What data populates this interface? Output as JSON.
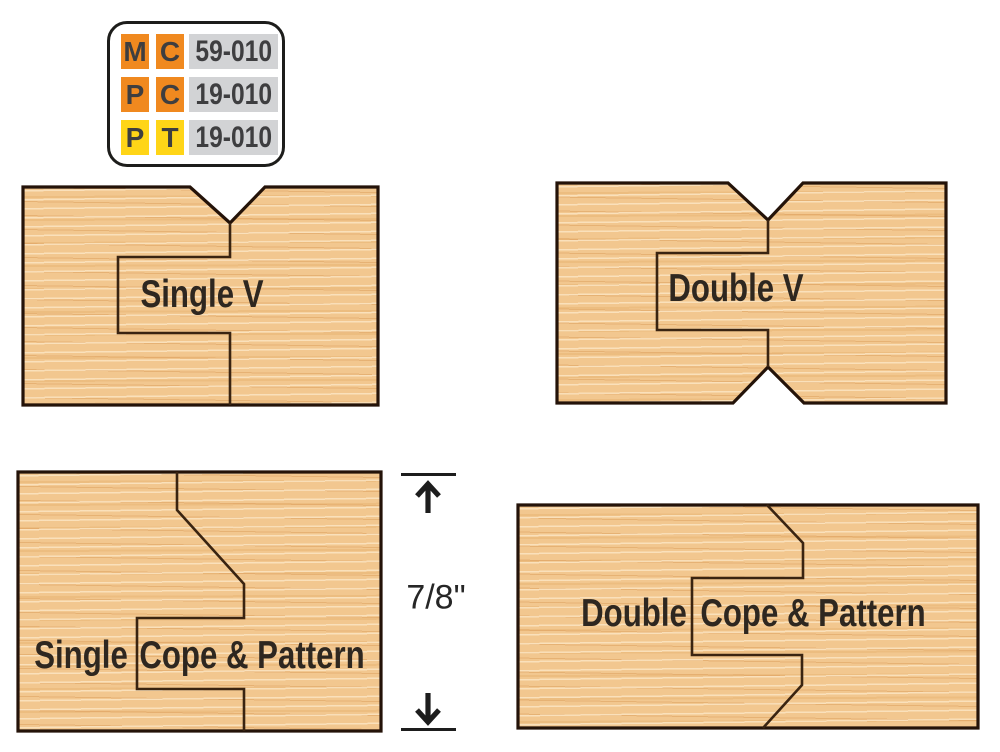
{
  "legend": {
    "rows": [
      {
        "tool": "M",
        "type": "C",
        "code": "59-010",
        "chip_color": "#f0891f"
      },
      {
        "tool": "P",
        "type": "C",
        "code": "19-010",
        "chip_color": "#f0891f"
      },
      {
        "tool": "P",
        "type": "T",
        "code": "19-010",
        "chip_color": "#ffd517"
      }
    ]
  },
  "panels": {
    "single_v": {
      "label": "Single V"
    },
    "double_v": {
      "label": "Double V"
    },
    "single_cope_pattern": {
      "label_left": "Single",
      "label_right": "Cope & Pattern"
    },
    "double_cope_pattern": {
      "label_left": "Double",
      "label_right": "Cope & Pattern"
    }
  },
  "dimension": {
    "label": "7/8\""
  },
  "colors": {
    "wood_base": "#f2c78f",
    "wood_streak_light": "#fce7c6",
    "wood_streak_dark": "#db9c5a",
    "panel_outline": "#241309",
    "joint_line": "#3a2411",
    "legend_orange": "#f0891f",
    "legend_yellow": "#ffd517",
    "legend_gray": "#d2d3d5",
    "legend_text": "#3e3e40",
    "panel_label_text": "#2e2720",
    "dimension_text": "#262626"
  }
}
